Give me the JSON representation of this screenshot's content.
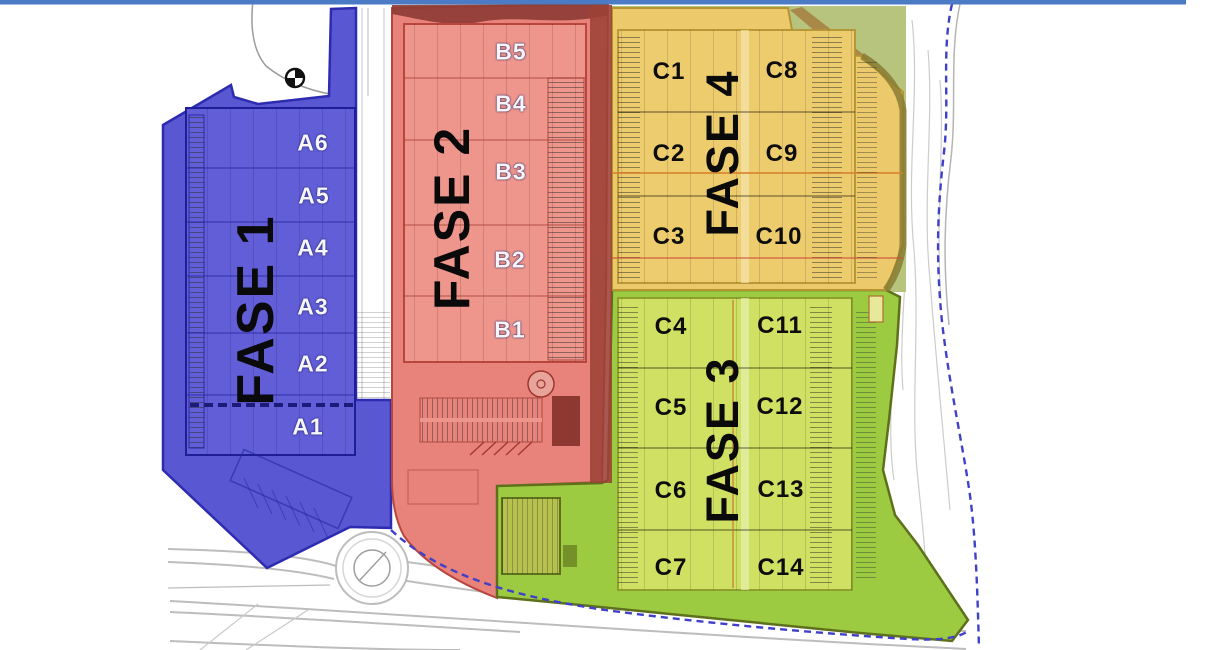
{
  "site_plan": {
    "kind": "industrial park phasing masterplan",
    "top_boundary_color": "#4a7bc4",
    "site_boundary_color": "#4040c8"
  },
  "phases": {
    "fase1": {
      "label": "FASE 1",
      "color": "#5a57d2",
      "units": {
        "a1": "A1",
        "a2": "A2",
        "a3": "A3",
        "a4": "A4",
        "a5": "A5",
        "a6": "A6"
      }
    },
    "fase2": {
      "label": "FASE 2",
      "color": "#e8837b",
      "units": {
        "b1": "B1",
        "b2": "B2",
        "b3": "B3",
        "b4": "B4",
        "b5": "B5"
      }
    },
    "fase3": {
      "label": "FASE 3",
      "color": "#9ccb41",
      "units": {
        "c4": "C4",
        "c5": "C5",
        "c6": "C6",
        "c7": "C7",
        "c11": "C11",
        "c12": "C12",
        "c13": "C13",
        "c14": "C14"
      }
    },
    "fase4": {
      "label": "FASE 4",
      "color": "#ecc96a",
      "units": {
        "c1": "C1",
        "c2": "C2",
        "c3": "C3",
        "c8": "C8",
        "c9": "C9",
        "c10": "C10"
      }
    }
  },
  "icons": {
    "compass": "north-compass-icon"
  }
}
